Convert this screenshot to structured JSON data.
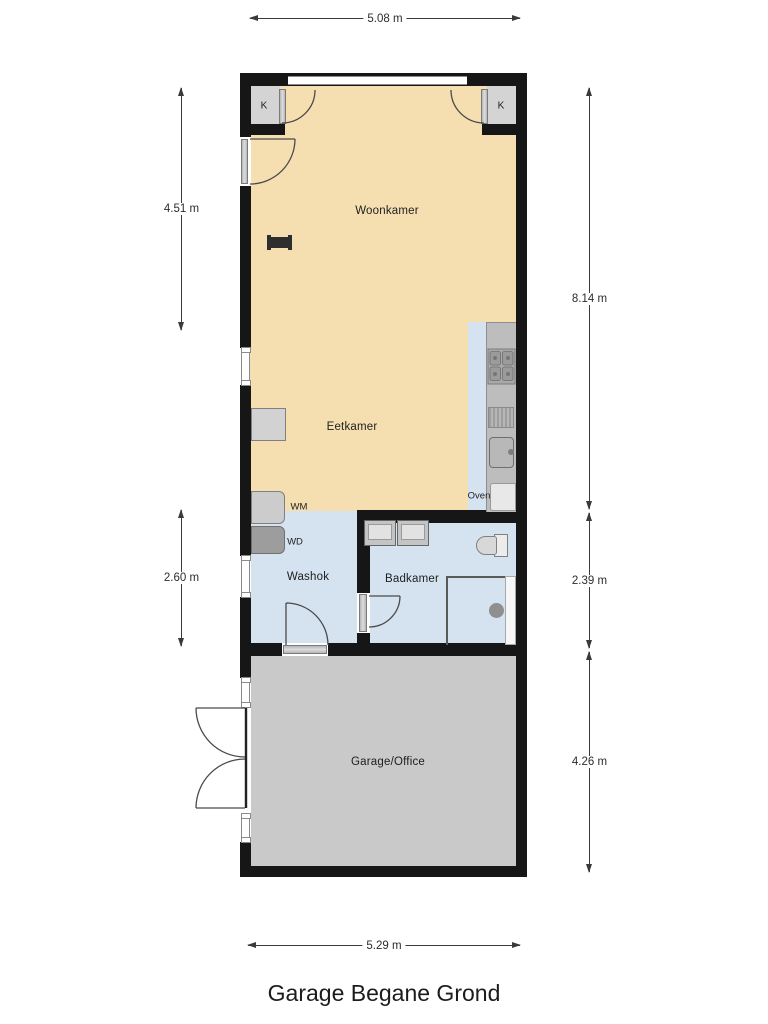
{
  "title": "Garage Begane Grond",
  "dimensions": {
    "top": "5.08 m",
    "left_upper": "4.51 m",
    "left_lower": "2.60 m",
    "right_upper": "8.14 m",
    "right_middle": "2.39 m",
    "right_lower": "4.26 m",
    "bottom": "5.29 m"
  },
  "rooms": {
    "woonkamer": "Woonkamer",
    "eetkamer": "Eetkamer",
    "washok": "Washok",
    "badkamer": "Badkamer",
    "garage": "Garage/Office"
  },
  "labels": {
    "closet_left": "K",
    "closet_right": "K",
    "washer": "WM",
    "dryer": "WD",
    "oven": "Oven"
  },
  "colors": {
    "living_floor": "#F5DFB0",
    "wet_floor": "#D5E3F0",
    "garage_floor": "#C9C9C9",
    "closet_floor": "#D4D4D4",
    "counter": "#BDBDBD",
    "wall": "#161616",
    "dimension": "#3A3A3A"
  }
}
